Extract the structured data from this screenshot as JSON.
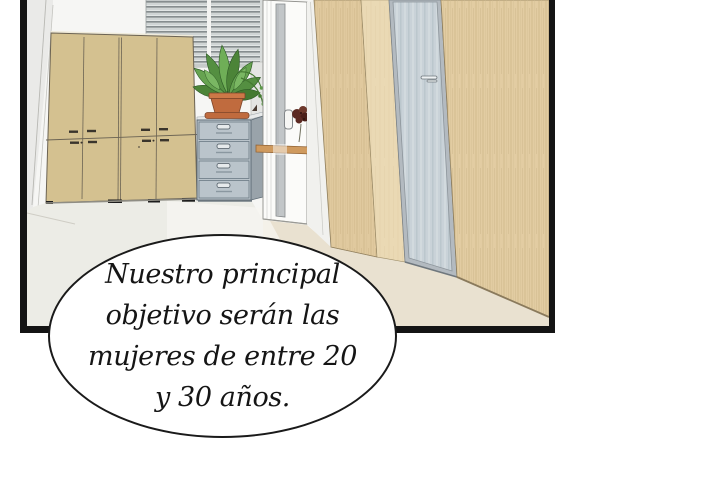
{
  "type": "comic-panel",
  "speech_bubble": {
    "lines": [
      "Nuestro principal",
      "objetivo serán las",
      "mujeres de entre 20",
      "y 30 años."
    ],
    "full_text": "Nuestro principal objetivo serán las mujeres de entre 20 y 30 años."
  },
  "palette": {
    "panel_border": "#141414",
    "bubble_outline": "#1a1a1a",
    "bubble_fill": "#ffffff",
    "wall_white": "#f6f6f4",
    "cabinet_tan": "#d4c190",
    "wood_panel": "#e0c99e",
    "frosted_glass": "#c9d2d8",
    "filing_cabinet_gray": "#b9c3ca",
    "floor_room": "#ecece6",
    "floor_hall": "#e9e1d0",
    "plant_green": "#5f9c49",
    "pot_terracotta": "#c06b3e",
    "handrail_wood": "#cf9a5e",
    "flower_dark_red": "#5c2a23",
    "blinds_gray": "#868d8f",
    "text_color": "#151515"
  },
  "scene_objects": [
    "storage-cabinet",
    "window-blinds",
    "potted-plant",
    "filing-cabinet",
    "open-white-door",
    "door-handle",
    "flower-bouquet",
    "wall-handrail",
    "wood-panel-wall",
    "frosted-glass-door",
    "hallway-floor"
  ]
}
